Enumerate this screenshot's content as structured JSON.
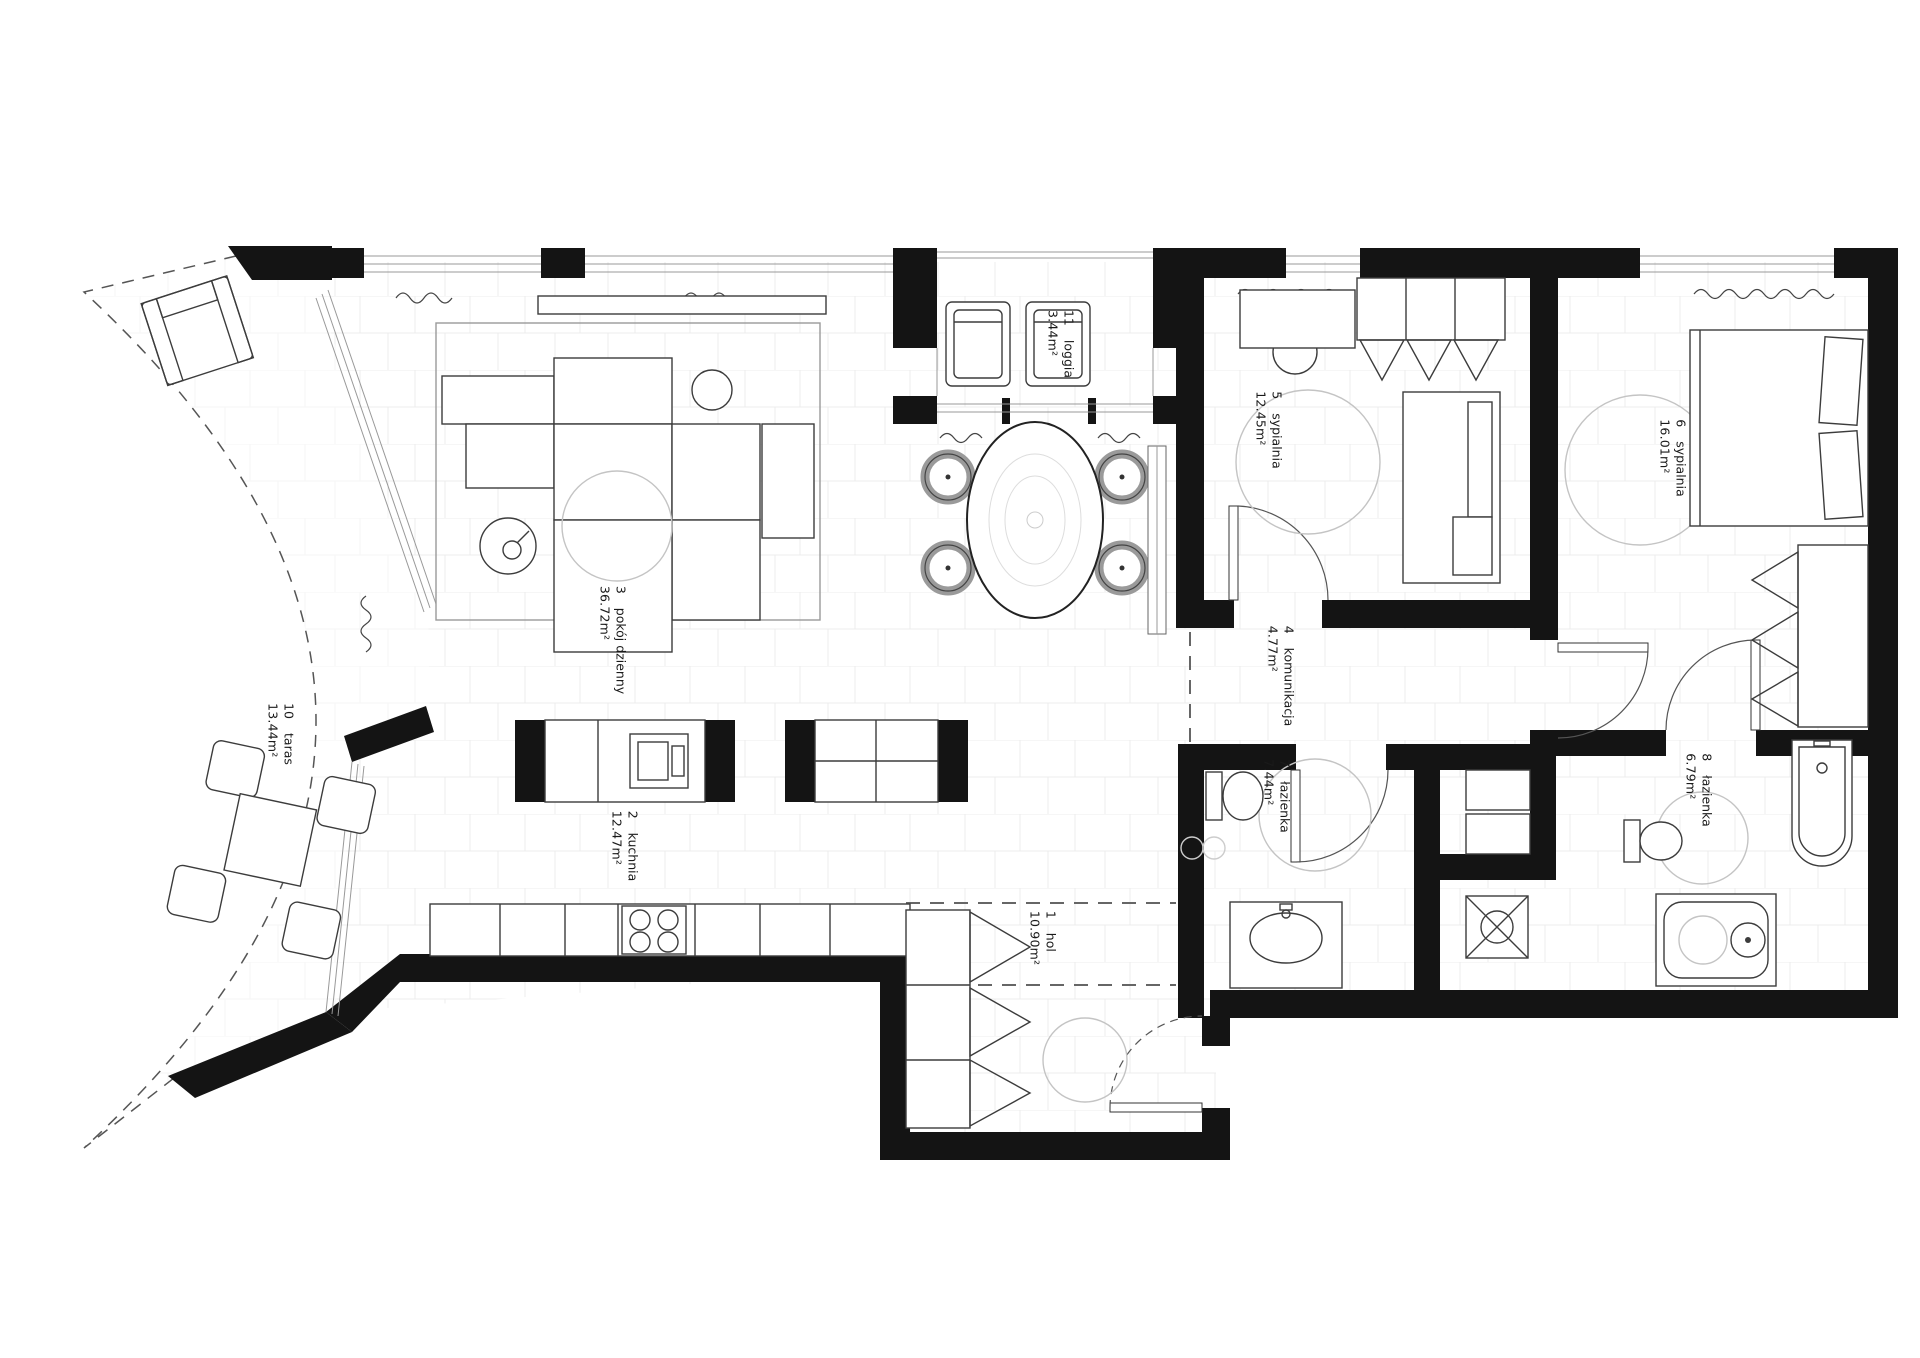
{
  "document": {
    "type": "apartment-floor-plan"
  },
  "rooms": [
    {
      "number": "1",
      "name": "hol",
      "area": "10.90m²"
    },
    {
      "number": "2",
      "name": "kuchnia",
      "area": "12.47m²"
    },
    {
      "number": "3",
      "name": "pokój dzienny",
      "area": "36.72m²"
    },
    {
      "number": "4",
      "name": "komunikacja",
      "area": "4.77m²"
    },
    {
      "number": "5",
      "name": "sypialnia",
      "area": "12.45m²"
    },
    {
      "number": "6",
      "name": "sypialnia",
      "area": "16.01m²"
    },
    {
      "number": "7",
      "name": "łazienka",
      "area": "7.44m²"
    },
    {
      "number": "8",
      "name": "łazienka",
      "area": "6.79m²"
    },
    {
      "number": "10",
      "name": "taras",
      "area": "13.44m²"
    },
    {
      "number": "11",
      "name": "loggia",
      "area": "3.44m²"
    }
  ],
  "colors": {
    "wall": "#141414",
    "furniture_line": "#3c3c3c",
    "light_line": "#c4c4c4",
    "floor_tile_line": "#ececec",
    "background": "#ffffff"
  }
}
